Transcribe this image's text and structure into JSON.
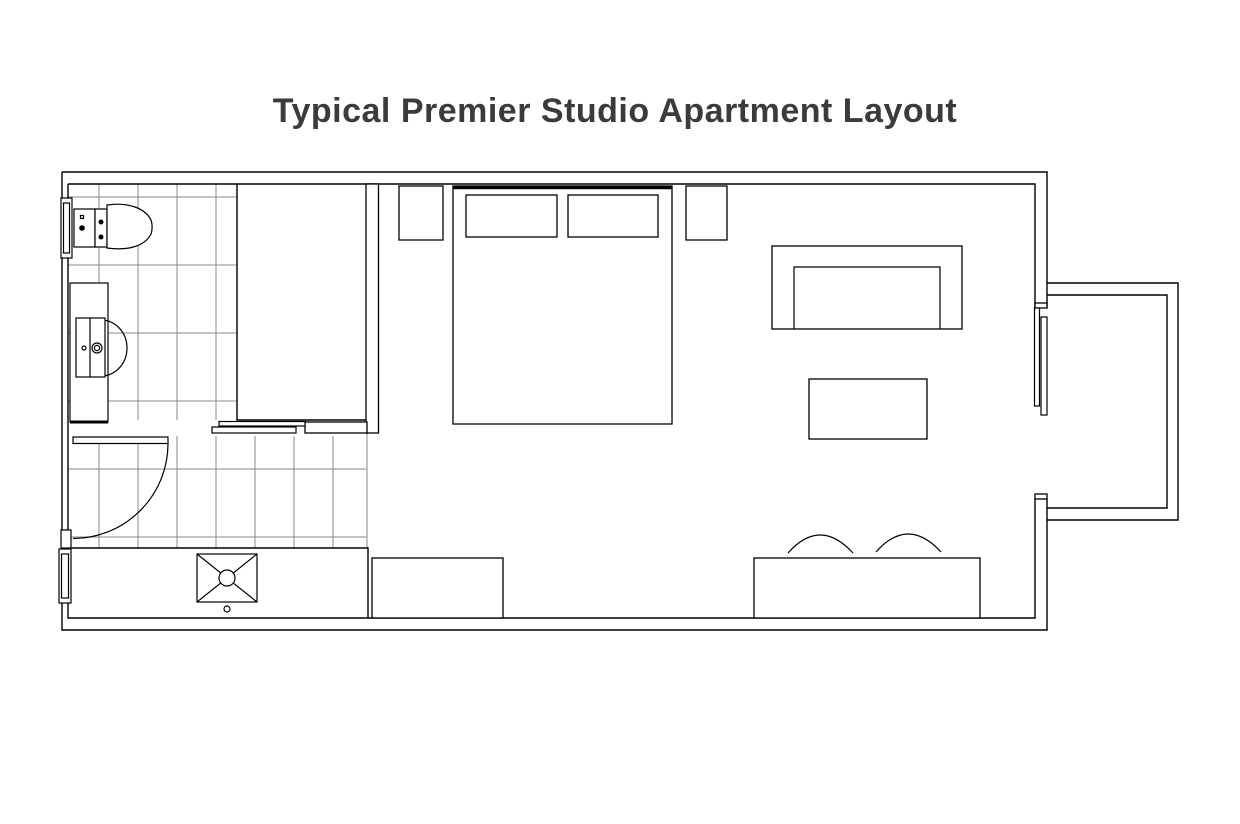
{
  "title": {
    "text": "Typical Premier Studio Apartment Layout",
    "color": "#3b3b3b"
  },
  "canvas": {
    "background": "#ffffff",
    "wall_color": "#000000",
    "tile_grid_color": "#8a8a8a"
  },
  "plan": {
    "type": "studio-apartment-floor-plan",
    "rooms": [
      {
        "id": "bathroom",
        "features": [
          "toilet",
          "vanity-with-sink",
          "tiled-floor",
          "swing-door",
          "shower-band-with-floor-drain",
          "window-upper",
          "window-lower"
        ]
      },
      {
        "id": "closet",
        "features": [
          "sliding-door-two-panels"
        ]
      },
      {
        "id": "sleeping-area",
        "features": [
          "double-bed",
          "pillow-left",
          "pillow-right",
          "nightstand-left",
          "nightstand-right",
          "dresser"
        ]
      },
      {
        "id": "living-area",
        "features": [
          "sofa",
          "coffee-table",
          "desk-console",
          "chair-left",
          "chair-right"
        ]
      },
      {
        "id": "balcony",
        "features": [
          "sliding-glass-door-two-panels"
        ]
      }
    ]
  }
}
